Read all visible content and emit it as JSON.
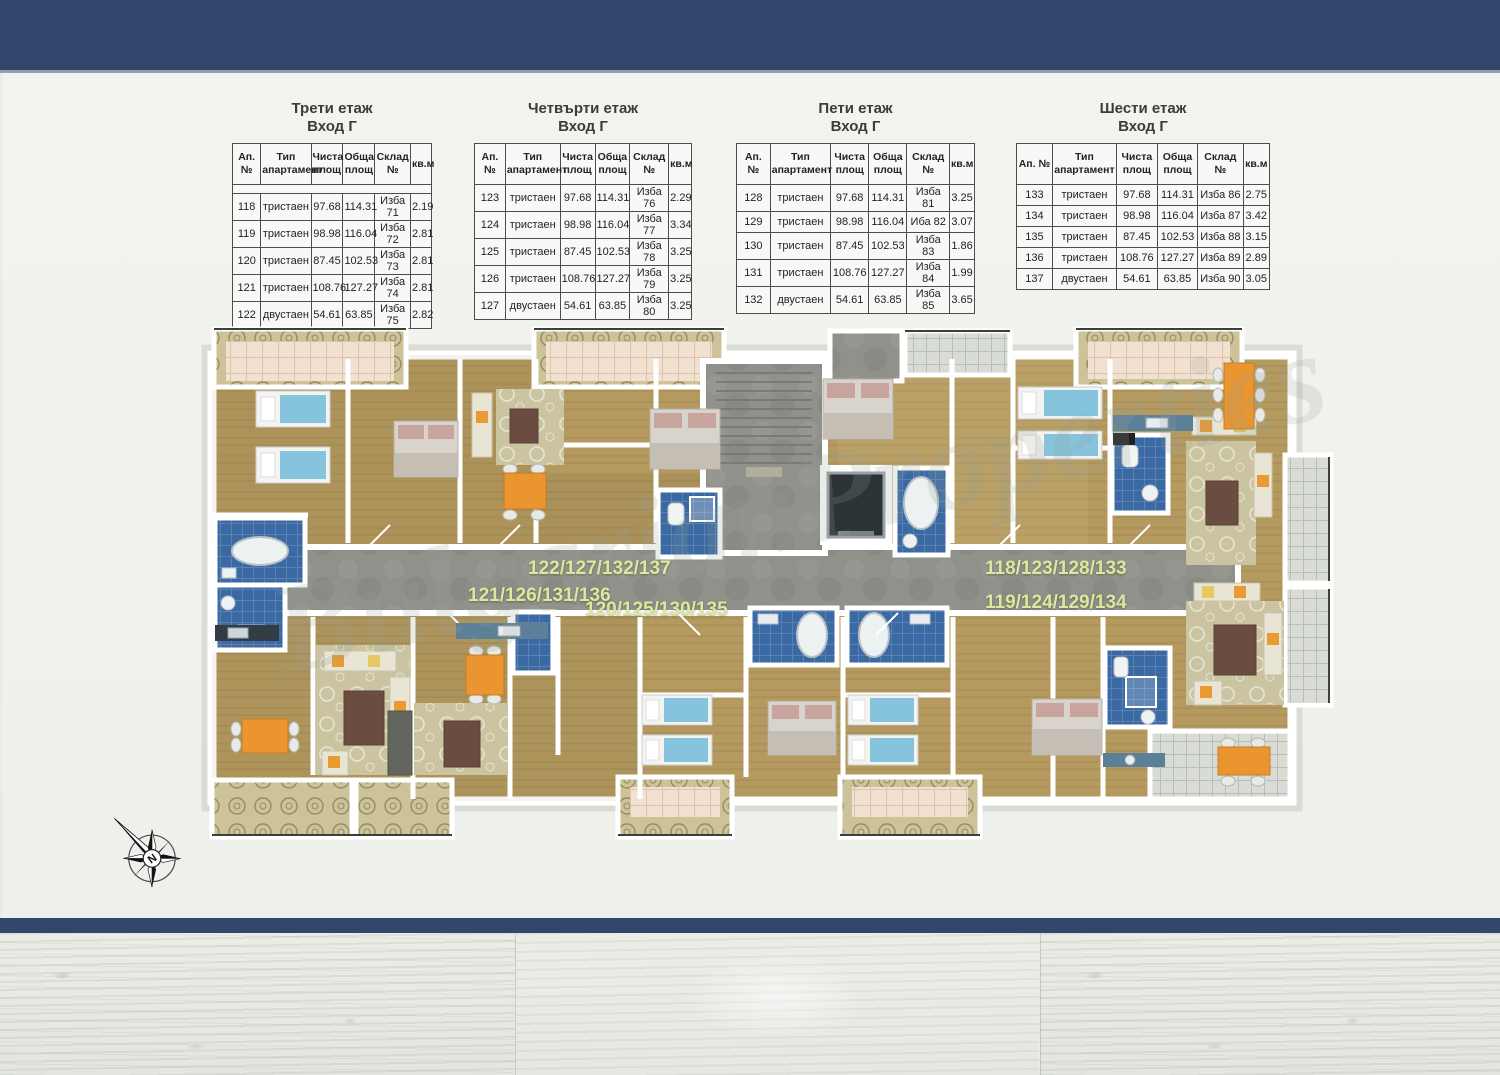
{
  "colors": {
    "navy": "#32456a",
    "label": "#dde89c",
    "wood": "#b49a5f",
    "bath": "#3a69a3"
  },
  "tables": [
    {
      "title": "Трети етаж",
      "subtitle": "Вход Г",
      "columns": [
        "Ап. №",
        "Тип\nапартамент",
        "Чиста\nплощ",
        "Обща\nплощ",
        "Склад №",
        "кв.м"
      ],
      "spacer_after_header": true,
      "rows": [
        [
          "118",
          "тристаен",
          "97.68",
          "114.31",
          "Изба 71",
          "2.19"
        ],
        [
          "119",
          "тристаен",
          "98.98",
          "116.04",
          "Изба 72",
          "2.81"
        ],
        [
          "120",
          "тристаен",
          "87.45",
          "102.53",
          "Изба 73",
          "2.81"
        ],
        [
          "121",
          "тристаен",
          "108.76",
          "127.27",
          "Изба 74",
          "2.81"
        ],
        [
          "122",
          "двустаен",
          "54.61",
          "63.85",
          "Изба 75",
          "2.82"
        ]
      ]
    },
    {
      "title": "Четвърти етаж",
      "subtitle": "Вход Г",
      "columns": [
        "Ап. №",
        "Тип\nапартамент",
        "Чиста\nплощ",
        "Обща\nплощ",
        "Склад №",
        "кв.м"
      ],
      "spacer_after_header": false,
      "rows": [
        [
          "123",
          "тристаен",
          "97.68",
          "114.31",
          "Изба 76",
          "2.29"
        ],
        [
          "124",
          "тристаен",
          "98.98",
          "116.04",
          "Изба 77",
          "3.34"
        ],
        [
          "125",
          "тристаен",
          "87.45",
          "102.53",
          "Изба 78",
          "3.25"
        ],
        [
          "126",
          "тристаен",
          "108.76",
          "127.27",
          "Изба 79",
          "3.25"
        ],
        [
          "127",
          "двустаен",
          "54.61",
          "63.85",
          "Изба 80",
          "3.25"
        ]
      ]
    },
    {
      "title": "Пети етаж",
      "subtitle": "Вход Г",
      "columns": [
        "Ап. №",
        "Тип\nапартамент",
        "Чиста\nплощ",
        "Обща\nплощ",
        "Склад №",
        "кв.м"
      ],
      "spacer_after_header": false,
      "rows": [
        [
          "128",
          "тристаен",
          "97.68",
          "114.31",
          "Изба 81",
          "3.25"
        ],
        [
          "129",
          "тристаен",
          "98.98",
          "116.04",
          "Иба 82",
          "3.07"
        ],
        [
          "130",
          "тристаен",
          "87.45",
          "102.53",
          "Изба 83",
          "1.86"
        ],
        [
          "131",
          "тристаен",
          "108.76",
          "127.27",
          "Изба 84",
          "1.99"
        ],
        [
          "132",
          "двустаен",
          "54.61",
          "63.85",
          "Изба 85",
          "3.65"
        ]
      ]
    },
    {
      "title": "Шести етаж",
      "subtitle": "Вход Г",
      "columns": [
        "Ап. №",
        "Тип\nапартамент",
        "Чиста\nплощ",
        "Обща\nплощ",
        "Склад №",
        "кв.м"
      ],
      "spacer_after_header": false,
      "rows": [
        [
          "133",
          "тристаен",
          "97.68",
          "114.31",
          "Изба 86",
          "2.75"
        ],
        [
          "134",
          "тристаен",
          "98.98",
          "116.04",
          "Изба 87",
          "3.42"
        ],
        [
          "135",
          "тристаен",
          "87.45",
          "102.53",
          "Изба 88",
          "3.15"
        ],
        [
          "136",
          "тристаен",
          "108.76",
          "127.27",
          "Изба 89",
          "2.89"
        ],
        [
          "137",
          "двустаен",
          "54.61",
          "63.85",
          "Изба 90",
          "3.05"
        ]
      ]
    }
  ],
  "plan": {
    "labels": [
      {
        "text": "122/127/132/137"
      },
      {
        "text": "121/126/131/136"
      },
      {
        "text": "120/125/130/135"
      },
      {
        "text": "118/123/128/133"
      },
      {
        "text": "119/124/129/134"
      }
    ]
  },
  "watermark": "BulgarianProperties",
  "compass": {
    "letter": "N"
  }
}
